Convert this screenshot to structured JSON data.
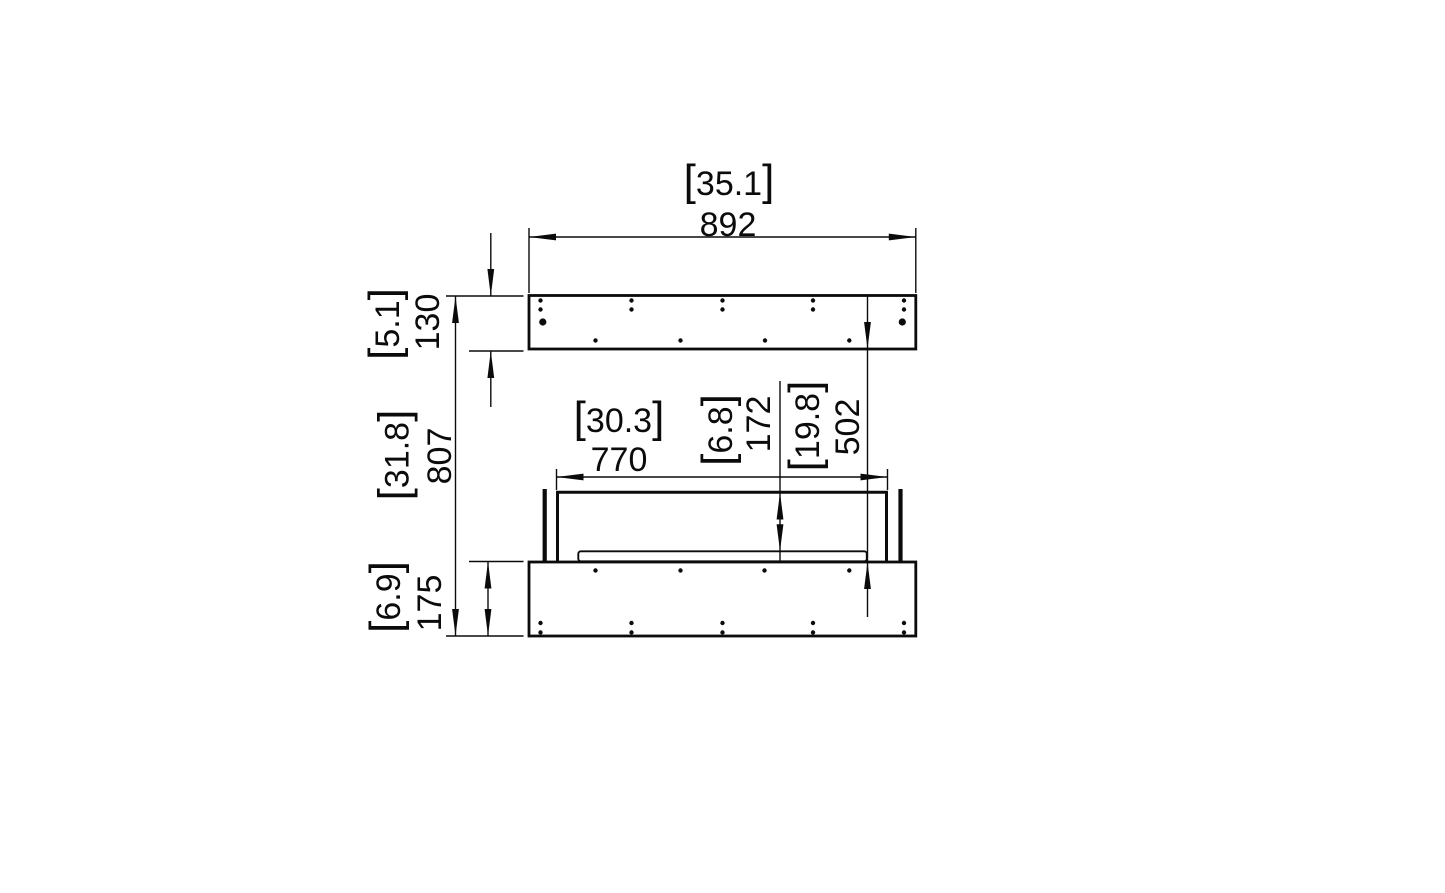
{
  "page": {
    "background_color": "#ffffff",
    "line_color": "#0b0b0b"
  },
  "drawing": {
    "kind": "technical dimension drawing, front section view, two stacked panels with burner tray",
    "brackets": {
      "open": "[",
      "close": "]"
    },
    "dimensions": {
      "overall_width": {
        "inches": "35.1",
        "mm": "892"
      },
      "top_panel_height": {
        "inches": "5.1",
        "mm": "130"
      },
      "overall_height": {
        "inches": "31.8",
        "mm": "807"
      },
      "base_height": {
        "inches": "6.9",
        "mm": "175"
      },
      "opening_width": {
        "inches": "30.3",
        "mm": "770"
      },
      "opening_depth": {
        "inches": "6.8",
        "mm": "172"
      },
      "mid_clearance": {
        "inches": "19.8",
        "mm": "502"
      }
    }
  }
}
